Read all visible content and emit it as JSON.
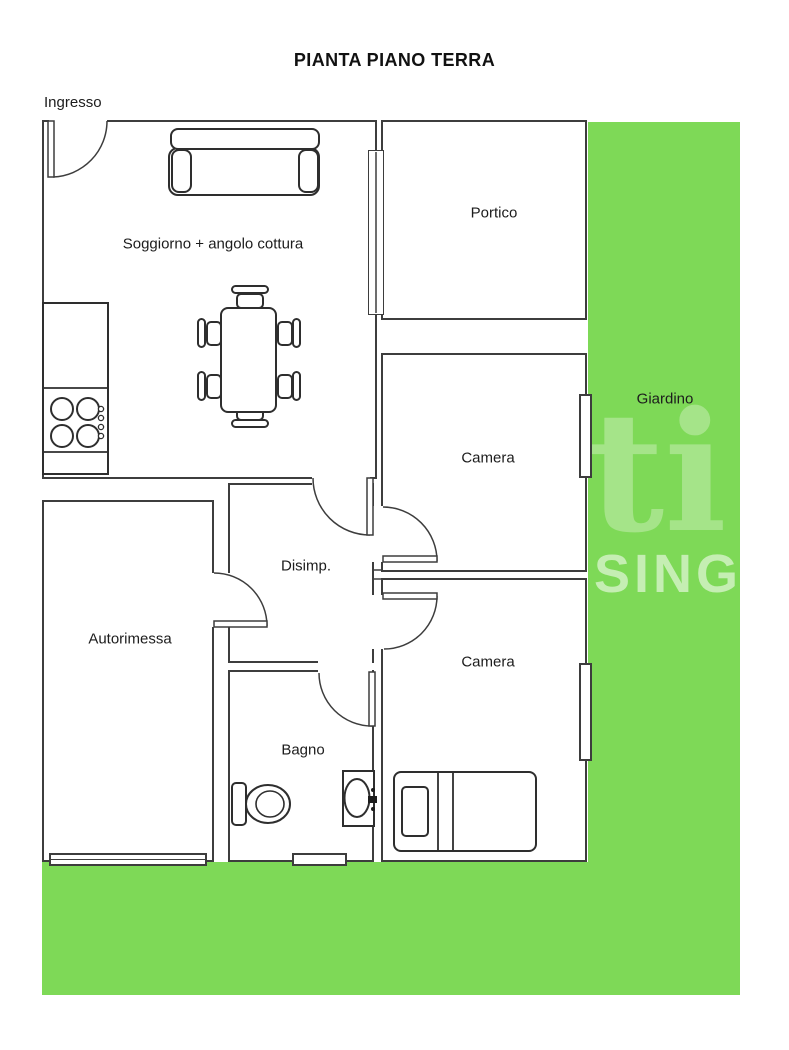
{
  "title": "PIANTA PIANO TERRA",
  "labels": {
    "ingresso": "Ingresso",
    "soggiorno": "Soggiorno + angolo cottura",
    "portico": "Portico",
    "giardino": "Giardino",
    "camera_top": "Camera",
    "camera_bottom": "Camera",
    "disimpegno": "Disimp.",
    "autorimessa": "Autorimessa",
    "bagno": "Bagno"
  },
  "watermark": {
    "symbol": "ti",
    "text": "HISING"
  },
  "colors": {
    "garden": "#7ed957",
    "wall": "#3d3d3d",
    "background": "#ffffff"
  }
}
